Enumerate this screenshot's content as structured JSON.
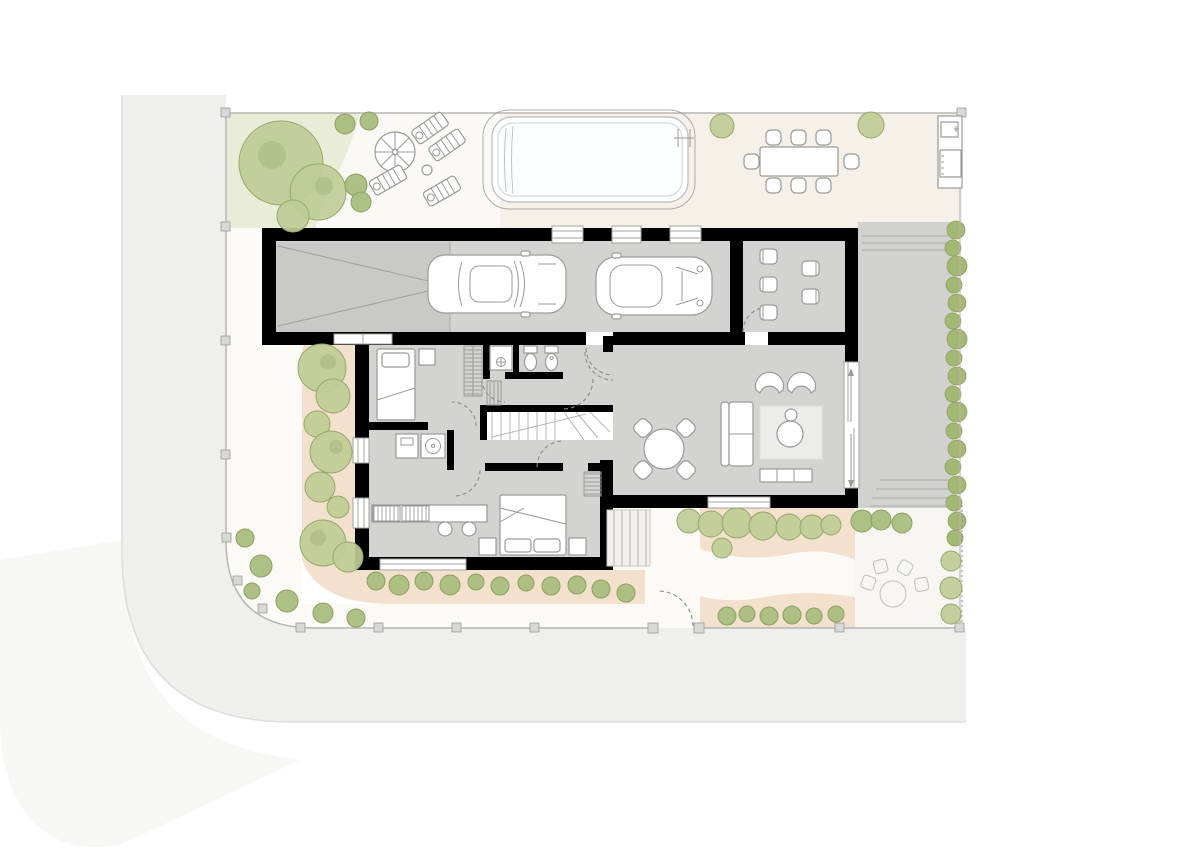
{
  "meta": {
    "kind": "architectural-site-plan",
    "level": "ground-floor",
    "orientation": "plan-view",
    "labels_visible": "none"
  },
  "colors": {
    "page": "#ffffff",
    "road": "#efefed",
    "curb": "#dddddb",
    "terrace": "#f5f0e8",
    "lawn": "#e9edd8",
    "path": "#fbfaf7",
    "bed": "#f3e1cd",
    "floor": "#d3d3d1",
    "garagezone": "#c9c9c7",
    "driveway": "#d1d1cf",
    "wall": "#000000",
    "treefill": "#bfcc95",
    "treeline": "#96a76c",
    "bushfill": "#a9bd7e",
    "bushline": "#8ca05f",
    "hedgefill": "#a3b873",
    "pool": "#fdfeff",
    "poolline": "#c3c3c1",
    "furnline": "#9a9a98",
    "furnfill": "#ffffff",
    "rug": "#ececea",
    "fence": "#b5b5b3",
    "post": "#d8d8d6",
    "door": "#8a8a88",
    "window": "#a3a3a1",
    "sketch": "#c2c2c0",
    "stepline": "#b5b5b3",
    "segarden": "#f8f6f2"
  },
  "site": {
    "road": {
      "position": "west-and-south",
      "corner": "rounded"
    },
    "boundary": {
      "fence_posts": 17,
      "pedestrian_gate": "south",
      "dashed_line": "south-east"
    },
    "lawn_nw": {
      "large_trees": 3,
      "small_shrubs": 4
    },
    "sun_deck": {
      "parasol": 1,
      "side_table": 1,
      "loungers": 4
    },
    "pool": {
      "shape": "rounded-rectangle",
      "ladder": "east-end"
    },
    "outdoor_dining": {
      "table": 1,
      "chairs": 8
    },
    "outdoor_kitchen": {
      "units": [
        "sink",
        "grill"
      ]
    },
    "driveway": {
      "position": "east",
      "hedge_east": true,
      "paving_lines": true
    },
    "planting_beds": {
      "west": {
        "trees": 8
      },
      "south_west": {
        "shrubs": 11
      },
      "south_east": {
        "trees": 8,
        "shrubs": 9,
        "winding_path": true
      }
    },
    "garden_seating_sketch": {
      "round_table": 1,
      "chairs": 4
    },
    "corner_shrubs": 6,
    "boundary_trees_se": 3
  },
  "house": {
    "exterior_steps": {
      "location": "south-center",
      "treads": 5
    },
    "windows": {
      "north": 3,
      "west": 3,
      "south": 2,
      "east_sliding_door": 1
    },
    "rooms": [
      {
        "id": "garage",
        "cars": 2,
        "door_type": "up-and-over"
      },
      {
        "id": "studio",
        "seats": 5
      },
      {
        "id": "living-dining",
        "furniture": [
          "round-table",
          "four-chairs",
          "sofa",
          "two-armchairs",
          "rug",
          "pouf",
          "tv-sideboard"
        ]
      },
      {
        "id": "hall"
      },
      {
        "id": "stairs",
        "treads": 8,
        "winders": 3
      },
      {
        "id": "bedroom-1",
        "furniture": [
          "single-bed",
          "nightstand",
          "wardrobe"
        ]
      },
      {
        "id": "shower-room",
        "fixtures": [
          "shower"
        ]
      },
      {
        "id": "wc",
        "fixtures": [
          "toilet",
          "bidet"
        ]
      },
      {
        "id": "utility",
        "appliances": [
          "washer",
          "sink-unit"
        ]
      },
      {
        "id": "study",
        "furniture": [
          "desk",
          "two-stools"
        ]
      },
      {
        "id": "bedroom-2",
        "furniture": [
          "double-bed",
          "two-nightstands",
          "wardrobe"
        ]
      }
    ]
  }
}
